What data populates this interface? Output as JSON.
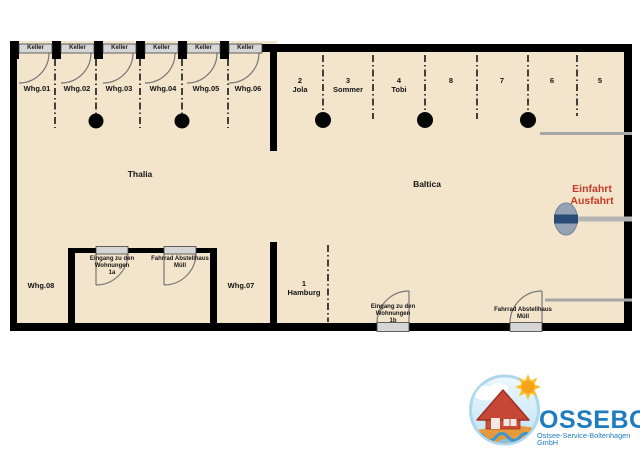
{
  "plan": {
    "thalia": {
      "name": "Thalia",
      "keller_label": "Keller",
      "apartments": [
        "Whg.01",
        "Whg.02",
        "Whg.03",
        "Whg.04",
        "Whg.05",
        "Whg.06"
      ],
      "apartment_08": "Whg.08",
      "apartment_07": "Whg.07",
      "entrance_house": {
        "line1": "Eingang zu den",
        "line2": "Wohnungen",
        "line3": "1a"
      },
      "bike_shed": {
        "line1": "Fahrrad Abstellhaus",
        "line2": "Müll"
      }
    },
    "baltica": {
      "name": "Baltica",
      "parking_spots": [
        {
          "number": "2",
          "label": "Jola"
        },
        {
          "number": "3",
          "label": "Sommer"
        },
        {
          "number": "4",
          "label": "Tobi"
        },
        {
          "number": "8",
          "label": ""
        },
        {
          "number": "7",
          "label": ""
        },
        {
          "number": "6",
          "label": ""
        },
        {
          "number": "5",
          "label": ""
        }
      ],
      "parking_spot_1": {
        "number": "1",
        "label": "Hamburg"
      },
      "entrance_door": {
        "line1": "Eingang zu den",
        "line2": "Wohnungen",
        "line3": "1b"
      },
      "bike_shed": {
        "line1": "Fahrrad Abstellhaus",
        "line2": "Müll"
      },
      "gate": {
        "line1": "Einfahrt",
        "line2": "Ausfahrt"
      }
    }
  },
  "logo": {
    "name": "OSSEBO",
    "tagline": "Ostsee-Service-Boltenhagen GmbH"
  },
  "colors": {
    "floor": "#f3e5cb",
    "wall": "#000000",
    "door_gray": "#d6d6d6",
    "gate_red": "#c43a28",
    "logo_blue": "#1e7dc0"
  }
}
